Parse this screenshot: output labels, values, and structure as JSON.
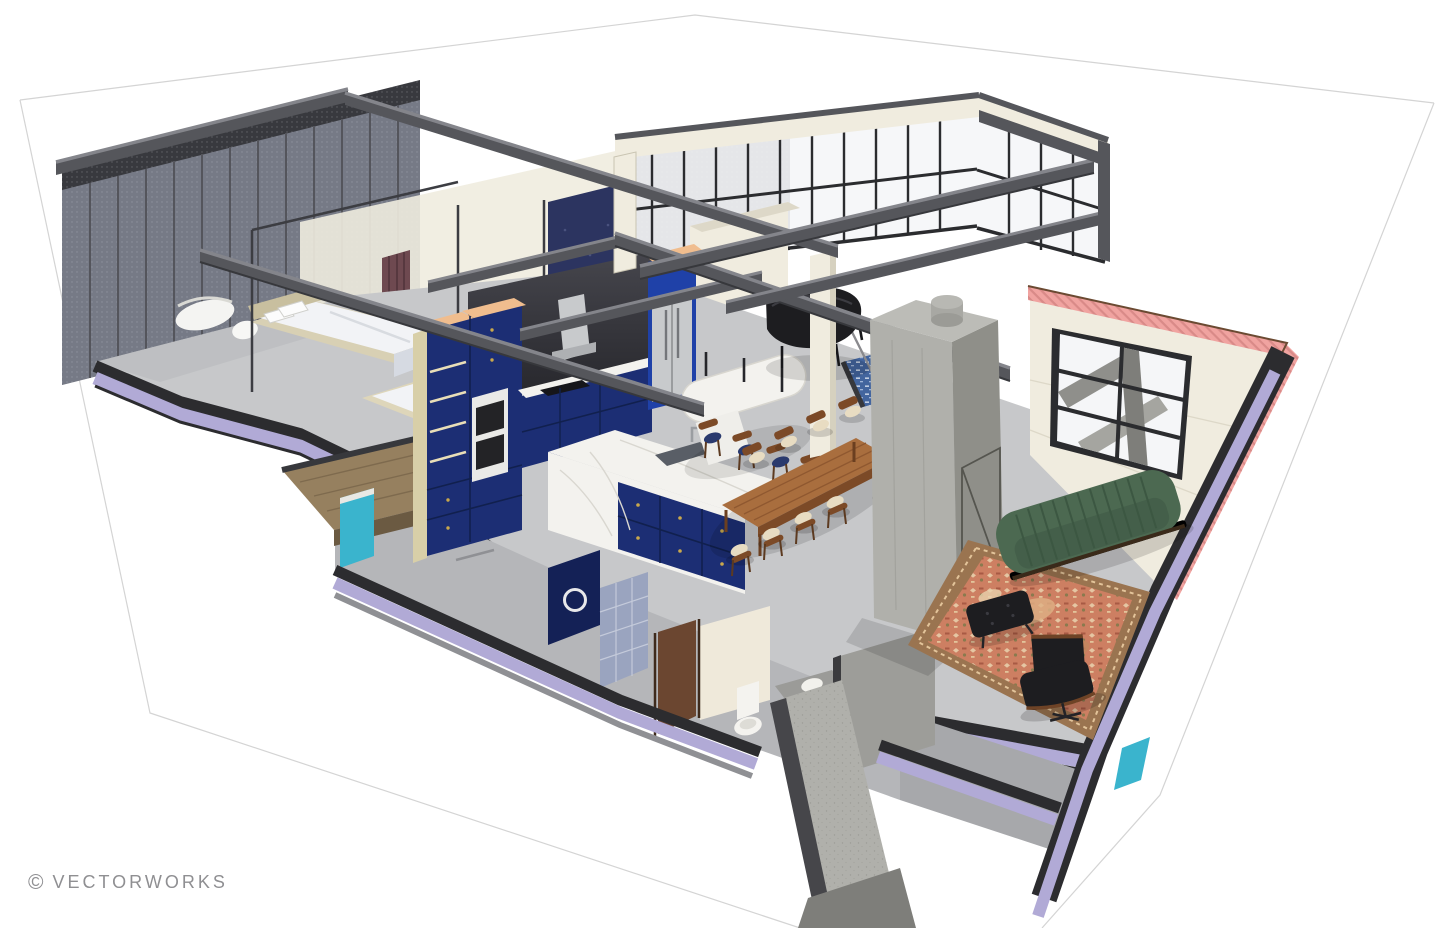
{
  "scene": {
    "type": "3d-architectural-cutaway-rendering",
    "subject": "two-story loft apartment section perspective",
    "watermark": {
      "symbol": "©",
      "text": "VECTORWORKS"
    }
  },
  "colors": {
    "background": "#ffffff",
    "wireframe": "#d4d4d4",
    "watermark_gray": "#8f8f92",
    "steel": "#55565b",
    "steel_light": "#84858b",
    "steel_dark": "#37383c",
    "mesh": "#2e2f34",
    "glass": "#c4cade",
    "glass_white": "#f5f6f8",
    "mullion": "#2b2c2f",
    "wall_cream": "#f0ecdf",
    "wall_white": "#f7f6f1",
    "navy_wall": "#2c3460",
    "curtain": "#6e4950",
    "floor_upper": "#c7c8ca",
    "floor_lower": "#b5b6b9",
    "slab_lavender": "#b1aad6",
    "slab_charcoal": "#2c2c2f",
    "concrete": "#b0b0ab",
    "concrete_shade": "#8f8f89",
    "cabinet_navy": "#1c2e74",
    "cabinet_navy_dark": "#142156",
    "fridge_blue": "#1f41a8",
    "appliance_steel": "#c8cacc",
    "marble": "#f3f2ee",
    "wood_counter": "#f0bd8e",
    "shelf_tan": "#d8cfa8",
    "wood_table": "#a96e3e",
    "wood_dark": "#7c4a27",
    "sofa_green": "#4c6951",
    "sofa_green_dark": "#3c5742",
    "rug_field": "#cd7f62",
    "rug_border": "#9a7450",
    "rug_cream": "#e9d3ae",
    "lounge_black": "#1d1d20",
    "cut_pink": "#f0a3a0",
    "cut_pink_hatch": "#d98a88",
    "teal_glass": "#3ab4cd",
    "deck_wood": "#96805f",
    "door_brown": "#6b4630",
    "fixture_white": "#f4f3ef",
    "stair_tile_blue": "#43659e",
    "bed_linen": "#f2f3f6",
    "bed_platform": "#d8d0b4"
  }
}
